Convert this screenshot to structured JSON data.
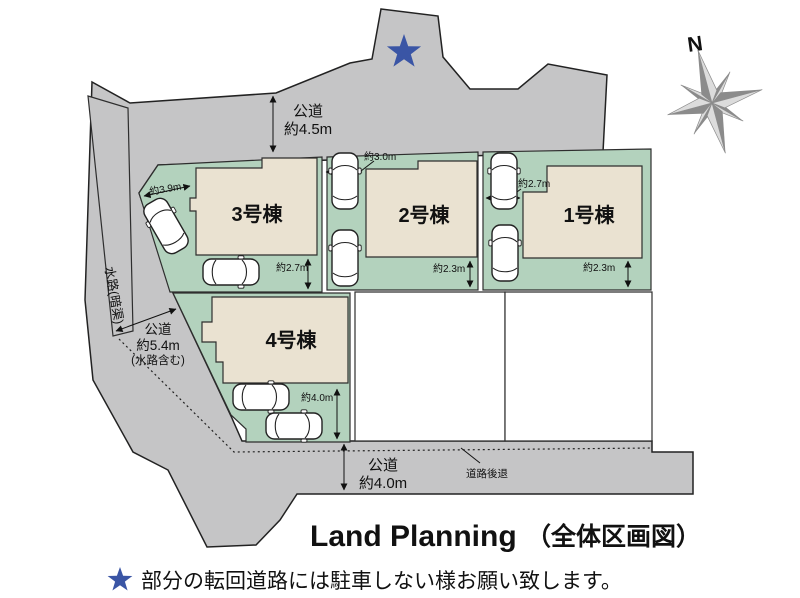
{
  "colors": {
    "road": "#c5c5c6",
    "plot_green": "#b3d2bd",
    "building": "#eae2d1",
    "accent_orange": "#e46f3a",
    "star_blue": "#3a55a5",
    "compass_gray": "#8b8b8b"
  },
  "compass": {
    "label": "N"
  },
  "roads": {
    "top": {
      "name": "公道",
      "width": "約4.5m"
    },
    "left": {
      "name": "公道",
      "width": "約5.4m",
      "note": "(水路含む)"
    },
    "bottom": {
      "name": "公道",
      "width": "約4.0m"
    },
    "waterway": "水路(暗渠)",
    "setback": "道路後退"
  },
  "units": [
    {
      "label": "1号棟",
      "dim_front": "約2.7m",
      "dim_side": "約2.3m"
    },
    {
      "label": "2号棟",
      "dim_front": "約3.0m",
      "dim_side": "約2.3m"
    },
    {
      "label": "3号棟",
      "dim_front": "約3.9m",
      "dim_side": "約2.7m"
    },
    {
      "label": "4号棟",
      "dim_side": "約4.0m"
    }
  ],
  "title": {
    "en": "Land Planning",
    "jp": "（全体区画図）"
  },
  "caption": {
    "star_icon": "★",
    "text": "部分の転回道路には駐車しない様お願い致します。"
  }
}
